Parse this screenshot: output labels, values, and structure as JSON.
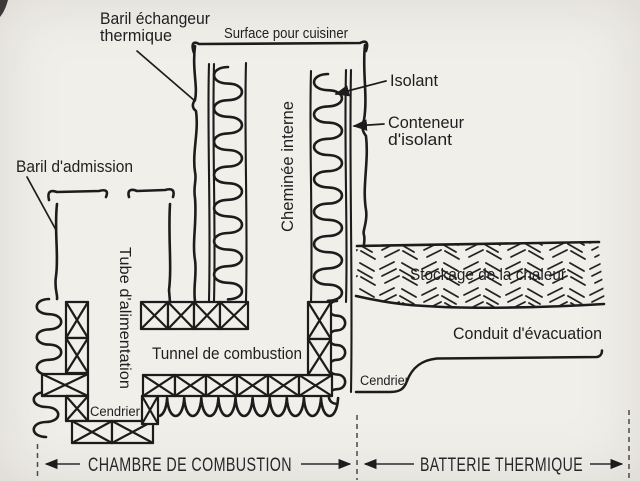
{
  "colors": {
    "paper": "#f1efea",
    "ink": "#1c1c1c",
    "text": "#1f1f1f",
    "dashed_guides": "#4a4a4a"
  },
  "diagram": {
    "type": "rocket-mass-heater-cross-section",
    "labels": {
      "heat_exchanger_barrel_line1": "Baril échangeur",
      "heat_exchanger_barrel_line2": "thermique",
      "cooking_surface": "Surface pour cuisiner",
      "insulation": "Isolant",
      "insulation_container_line1": "Conteneur",
      "insulation_container_line2": "d'isolant",
      "intake_barrel": "Baril d'admission",
      "feed_tube": "Tube d'alimentation",
      "internal_chimney": "Cheminée interne",
      "heat_storage": "Stockage de la chaleur",
      "combustion_tunnel": "Tunnel de combustion",
      "exhaust_duct": "Conduit d'évacuation",
      "ash_pit_left": "Cendrier",
      "ash_pit_right": "Cendrier"
    },
    "zones": {
      "combustion_chamber": "CHAMBRE DE COMBUSTION",
      "thermal_battery": "BATTERIE THERMIQUE"
    }
  }
}
